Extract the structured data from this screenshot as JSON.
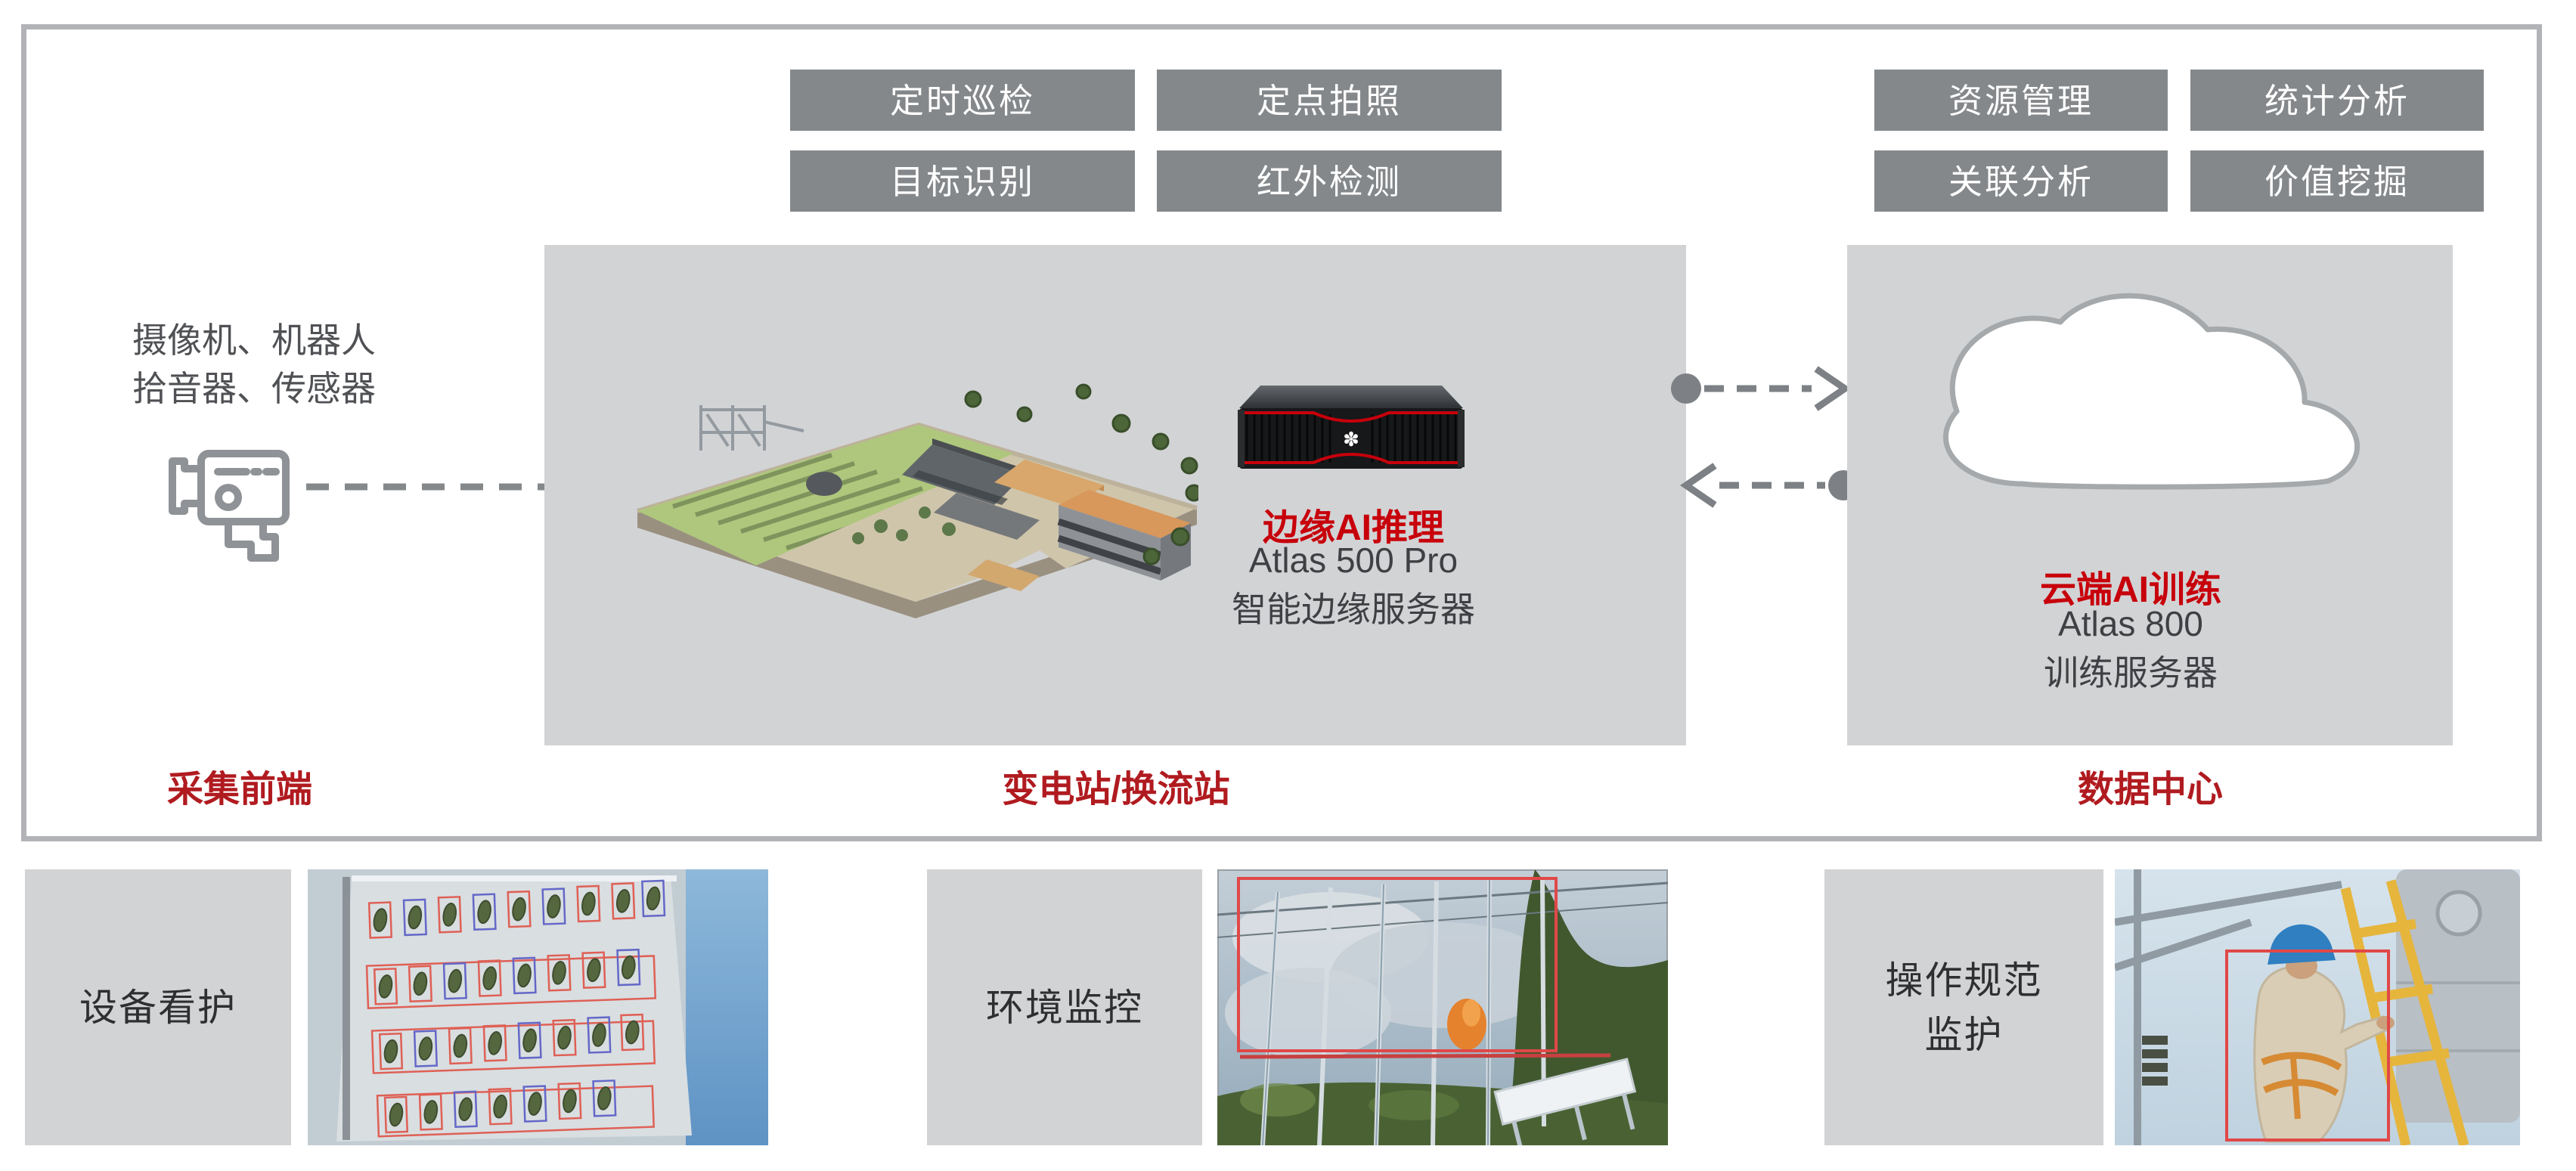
{
  "palette": {
    "accent_red": "#c7000b",
    "zone_label_red": "#b01b20",
    "chip_bg": "#85888b",
    "panel_bg": "#d2d3d5",
    "frame_border": "#b1b3b6",
    "connector_gray": "#7d8084",
    "icon_outline_gray": "#8f9296"
  },
  "edge_functions": [
    "定时巡检",
    "定点拍照",
    "目标识别",
    "红外检测"
  ],
  "cloud_functions": [
    "资源管理",
    "统计分析",
    "关联分析",
    "价值挖掘"
  ],
  "frontend": {
    "devices_line1": "摄像机、机器人",
    "devices_line2": "拾音器、传感器",
    "zone_label": "采集前端",
    "camera_icon": "cctv-camera-icon"
  },
  "edge": {
    "title": "边缘AI推理",
    "model": "Atlas 500 Pro",
    "desc": "智能边缘服务器",
    "zone_label": "变电站/换流站",
    "site_image": "substation-3d-model",
    "server_image": "atlas-500-pro-server"
  },
  "cloud": {
    "title": "云端AI训练",
    "model": "Atlas 800",
    "desc": "训练服务器",
    "zone_label": "数据中心",
    "cloud_icon": "cloud-shape"
  },
  "connectors": {
    "camera_to_edge": "dashed-line",
    "edge_to_cloud": "dashed-arrow-right",
    "cloud_to_edge": "dashed-arrow-left"
  },
  "scenarios": [
    {
      "label": "设备看护",
      "label_line2": "",
      "image": "equipment-detection-photo"
    },
    {
      "label": "环境监控",
      "label_line2": "",
      "image": "fire-smoke-detection-photo"
    },
    {
      "label": "操作规范",
      "label_line2": "监护",
      "image": "worker-safety-photo"
    }
  ]
}
